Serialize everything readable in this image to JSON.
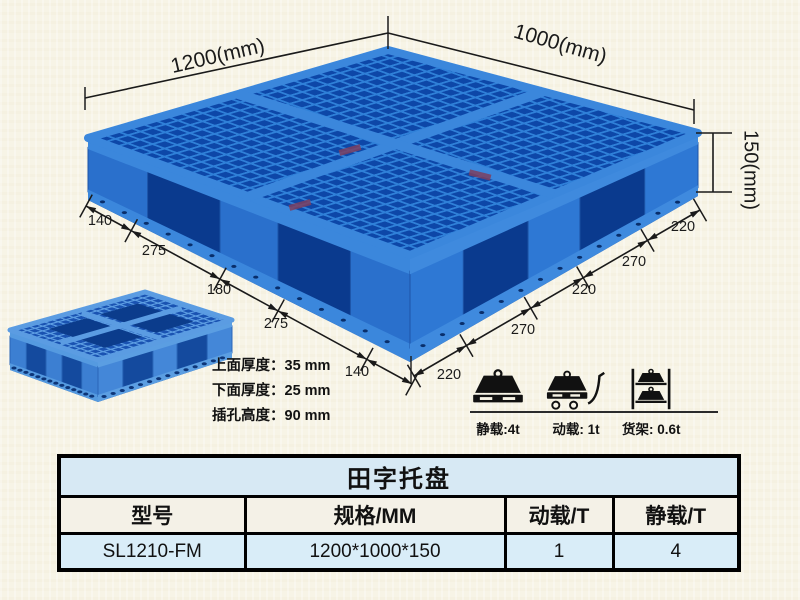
{
  "product": {
    "diagram_labels": {
      "width": "1200(mm)",
      "depth": "1000(mm)",
      "height": "150(mm)",
      "left_edge_segments": [
        "140",
        "275",
        "180",
        "275",
        "140"
      ],
      "left_edge_values": [
        140,
        275,
        180,
        275,
        140
      ],
      "right_edge_segments": [
        "220",
        "270",
        "220",
        "270",
        "220"
      ],
      "right_edge_values": [
        220,
        270,
        220,
        270,
        220
      ]
    },
    "thickness_specs": [
      {
        "text": "上面厚度：35 mm"
      },
      {
        "text": "下面厚度：25 mm"
      },
      {
        "text": "插孔高度：90 mm"
      }
    ],
    "load_ratings": [
      {
        "icon": "static-load-icon",
        "caption": "静载:4t"
      },
      {
        "icon": "dynamic-load-icon",
        "caption": "动载: 1t"
      },
      {
        "icon": "rack-load-icon",
        "caption": "货架: 0.6t"
      }
    ]
  },
  "table": {
    "title": "田字托盘",
    "columns": [
      "型号",
      "规格/MM",
      "动载/T",
      "静载/T"
    ],
    "rows": [
      [
        "SL1210-FM",
        "1200*1000*150",
        "1",
        "4"
      ]
    ]
  },
  "colors": {
    "background": "#f7f4e6",
    "pallet_rib_blue": "#2f80d8",
    "pallet_hole_blue": "#0d47a8",
    "pallet_band_blue": "#3b87dc",
    "line_color": "#1a1a1a",
    "table_title_bg": "#d7e9f4",
    "table_header_bg": "#f4f1e7",
    "table_data_bg": "#d9edf8"
  }
}
